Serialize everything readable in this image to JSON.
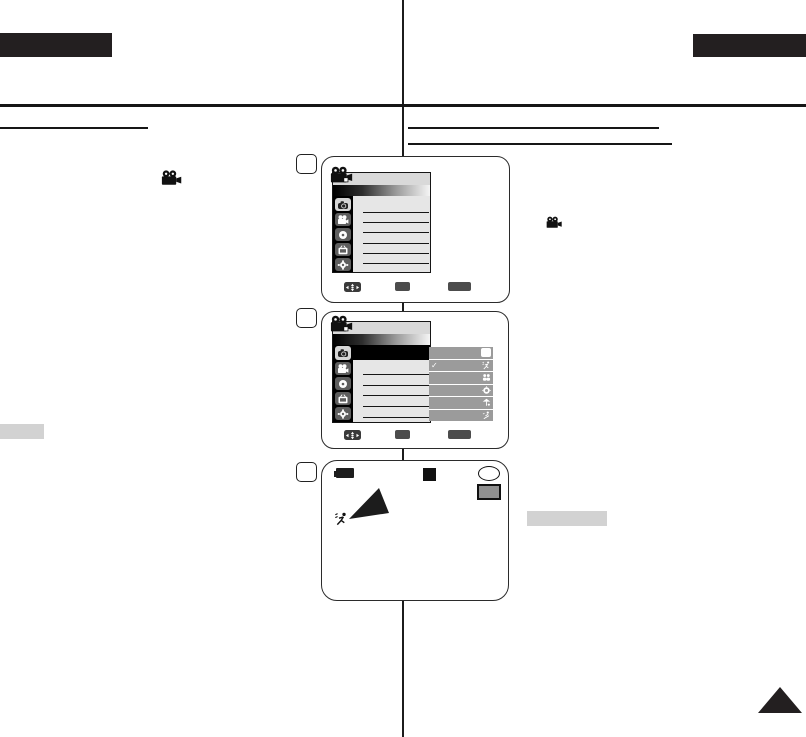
{
  "document": {
    "kind": "camcorder manual page (scanned, text not rendered)",
    "background": "#ffffff",
    "ink_color": "#231f20",
    "header": {
      "top_left_tab_color": "#231f20",
      "top_right_tab_color": "#231f20"
    },
    "left_column": {
      "heading_underline": true,
      "inline_icon": "movie-camera-icon",
      "highlight_bar_color": "#d2d2d2"
    },
    "right_column": {
      "heading_underlines": 2,
      "inline_icon": "movie-camera-icon",
      "highlight_bar_color": "#d2d2d2"
    },
    "page_turn_triangle_color": "#231f20"
  },
  "steps": [
    {
      "box_label": ""
    },
    {
      "box_label": ""
    },
    {
      "box_label": ""
    }
  ],
  "osd": {
    "titlebar_color": "#d9d9d9",
    "gradient_bar": [
      "#000000",
      "#f5f5f5"
    ],
    "sidebar_color": "#000000",
    "row_color": "#e6e6e6",
    "selected_row_color": "#000000",
    "submenu_color": "#9b9b9b",
    "footer_button_color": "#4c4c4c",
    "title_icon": "movie-camera-icon",
    "category_icons": [
      "photo-camera-icon",
      "movie-camera-icon",
      "disc-icon",
      "tv-icon",
      "gear-icon"
    ],
    "check_glyph": "✓",
    "submenu_rows": [
      {
        "icon": "auto-blank-square-icon",
        "checked": false
      },
      {
        "icon": "sports-runner-icon",
        "checked": true
      },
      {
        "icon": "portrait-icon",
        "checked": false
      },
      {
        "icon": "spotlight-icon",
        "checked": false
      },
      {
        "icon": "sand-snow-icon",
        "checked": false
      },
      {
        "icon": "high-speed-icon",
        "checked": false
      }
    ],
    "footer": {
      "move_icon": "dpad-move-icon",
      "button_labels": [
        "",
        ""
      ]
    }
  },
  "live_view": {
    "battery_icon": "battery-icon",
    "record_indicator": "black-square",
    "counter_icon": "white-circle",
    "storage_icon": "card-icon",
    "scene_indicator_icon": "sports-runner-icon",
    "scene_shape_color": "#1c1c1c"
  }
}
